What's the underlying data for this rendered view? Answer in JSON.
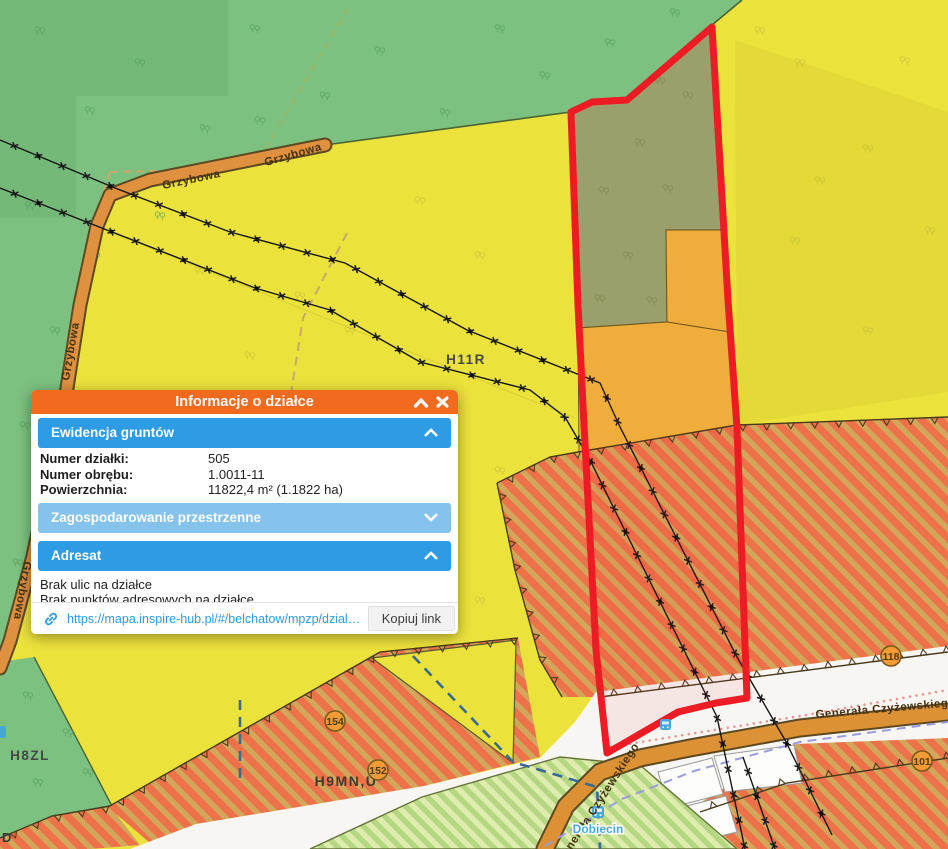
{
  "popup": {
    "title": "Informacje o działce",
    "icons": {
      "collapse": "chevron-up-icon",
      "close": "close-icon",
      "link": "link-icon",
      "section_expanded": "chevron-up-icon",
      "section_collapsed": "chevron-down-icon"
    },
    "sections": [
      {
        "label": "Ewidencja gruntów",
        "state": "expanded"
      },
      {
        "label": "Zagospodarowanie przestrzenne",
        "state": "collapsed"
      },
      {
        "label": "Adresat",
        "state": "expanded"
      }
    ],
    "fields": [
      {
        "label": "Numer działki:",
        "value": "505"
      },
      {
        "label": "Numer obrębu:",
        "value": "1.0011-11"
      },
      {
        "label": "Powierzchnia:",
        "value": "11822,4 m² (1.1822 ha)"
      }
    ],
    "address_lines": [
      "Brak ulic na działce",
      "Brak punktów adresowych na działce"
    ],
    "link": {
      "url": "https://mapa.inspire-hub.pl/#/belchatow/mpzp/dzialka/10…",
      "copy_button": "Kopiuj link"
    }
  },
  "map": {
    "zone_labels": {
      "h11r": "H11R",
      "h8zl": "H8ZL",
      "h9mnu": "H9MN,U"
    },
    "road_labels": {
      "grzybowa": "Grzybowa",
      "czyzewskiego": "Generała Czyżewskiego"
    },
    "road_badges": {
      "b118": "118",
      "b101": "101",
      "b154": "154",
      "b152": "152"
    },
    "bus_stop": {
      "name": "Dobiecin",
      "icon": "bus-stop-icon"
    },
    "edge_label_fragment": "D",
    "colors": {
      "selection_red": "#ED1C24",
      "forest_green": "#7CC180",
      "parcel_sage": "#93AA70",
      "field_yellow": "#ECE23C",
      "amber_zone": "#EFB93D",
      "hatch_orange": "#ED7149",
      "hatch_base": "#D2A75C",
      "road_orange": "#DF9140",
      "popup_orange": "#F26A1E",
      "popup_blue": "#2E9BE5",
      "popup_blue_light": "#85C2EC",
      "link_blue": "#2E9BE5"
    }
  }
}
